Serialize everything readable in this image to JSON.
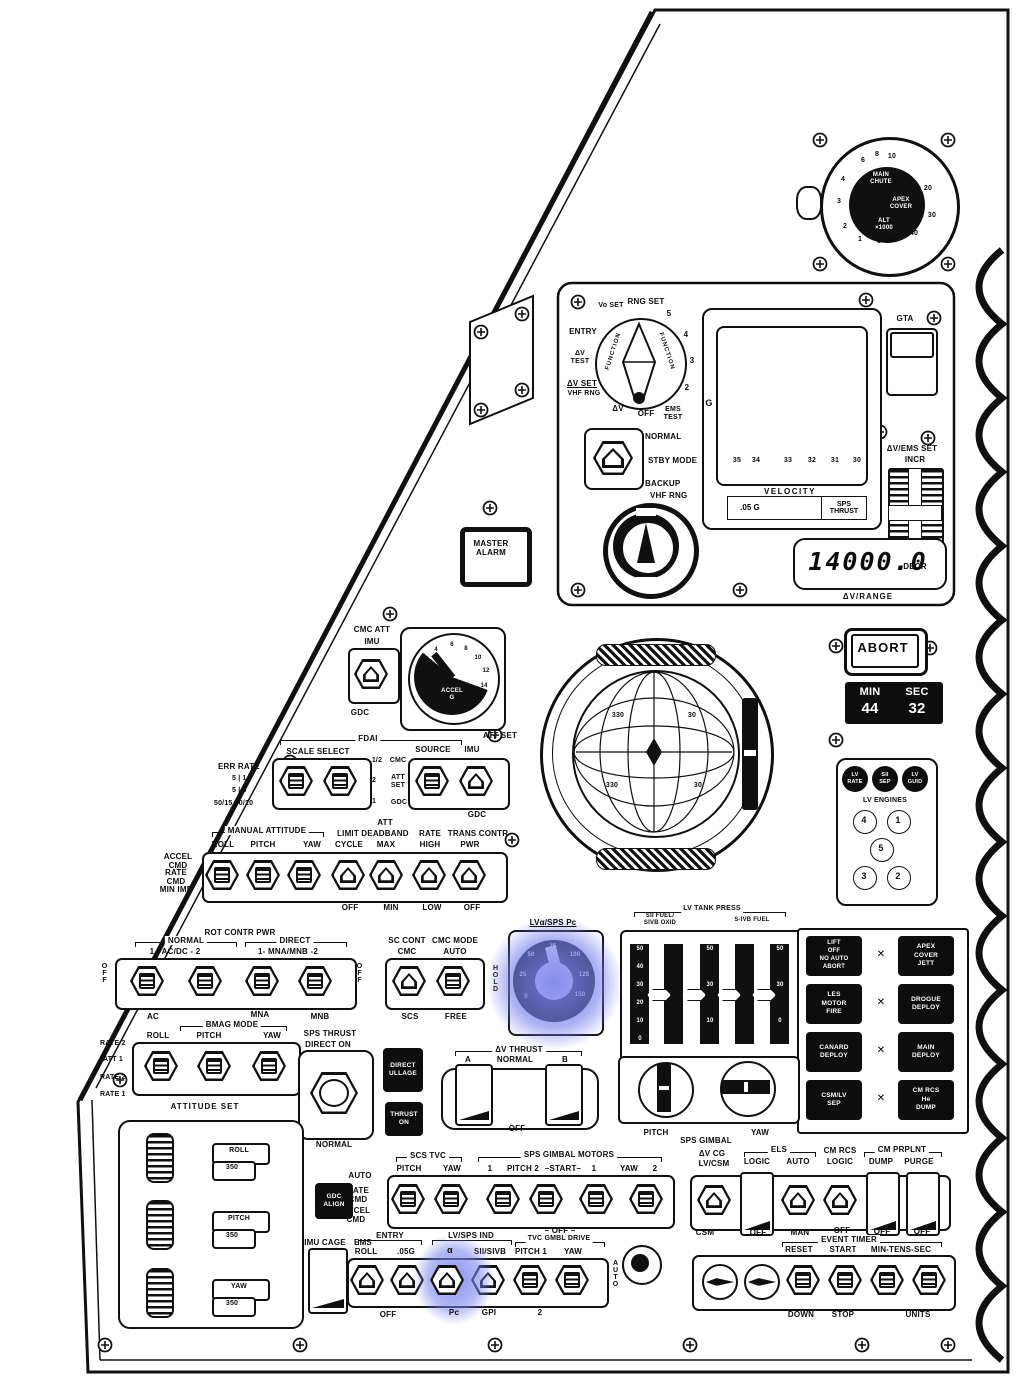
{
  "highlight_color": "#7882eb",
  "icons": {
    "xlink": "✕"
  },
  "altimeter": {
    "ticks": [
      "1",
      "2",
      "3",
      "4",
      "6",
      "8",
      "10",
      "20",
      "30",
      "40",
      "50",
      "0"
    ],
    "center": [
      "MAIN\nCHUTE",
      "APEX\nCOVER",
      "ALT\n×1000"
    ]
  },
  "ems": {
    "selector": {
      "entry": "ENTRY",
      "vo_set": "Vo SET",
      "rng_set": "RNG SET",
      "n5": "5",
      "n4": "4",
      "n3": "3",
      "n2": "2",
      "ems_test": "EMS\nTEST",
      "off": "OFF",
      "dv": "ΔV",
      "dv_set": "ΔV SET",
      "vhf_rng": "VHF RNG",
      "dv_test": "ΔV\nTEST",
      "knob": "FUNCTION"
    },
    "mode": {
      "normal": "NORMAL",
      "stby": "STBY MODE",
      "backup": "BACKUP",
      "vhf": "VHF RNG"
    },
    "gta": "GTA",
    "set": {
      "label": "ΔV/EMS SET",
      "incr": "INCR",
      "decr": "DECR"
    },
    "graph": {
      "g": "G",
      "x_ticks": [
        "35",
        "34",
        "33",
        "32",
        "31",
        "30"
      ],
      "x_label": "VELOCITY"
    },
    "lights": [
      ".05 G",
      "SPS\nTHRUST"
    ],
    "dv_display": {
      "value": "14000.0",
      "label": "ΔV/RANGE"
    }
  },
  "master_alarm": "MASTER\nALARM",
  "abort": "ABORT",
  "event_clock": {
    "min": "MIN",
    "sec": "SEC",
    "min_val": "44",
    "sec_val": "32"
  },
  "cmc_att": {
    "title": "CMC ATT",
    "imu": "IMU",
    "gdc": "GDC"
  },
  "accel": {
    "label": "ACCEL\nG",
    "ticks": [
      "0",
      "2",
      "4",
      "6",
      "8",
      "10",
      "12",
      "14",
      "16"
    ]
  },
  "fdai": {
    "ball_numbers": [
      "330",
      "30",
      "330",
      "30"
    ]
  },
  "fdai_sel": {
    "err_rate": "ERR RATE",
    "er1": "5 | 1",
    "er2": "5 | 5",
    "er3": "50/15 50/10",
    "fdai": "FDAI",
    "scale": "SCALE  SELECT",
    "mid": [
      "1/2",
      "2",
      "1"
    ],
    "src_col": [
      "CMC",
      "ATT\nSET",
      "GDC"
    ],
    "source": "SOURCE",
    "att_set": "ATT SET",
    "imu": "IMU",
    "gdc": "GDC"
  },
  "man_att": {
    "hdr": "MANUAL ATTITUDE",
    "cols": [
      "ROLL",
      "PITCH",
      "YAW"
    ],
    "left": [
      "ACCEL\nCMD",
      "RATE\nCMD",
      "MIN IMP"
    ],
    "limit": "LIMIT",
    "cycle": "CYCLE",
    "att": "ATT",
    "deadband": "DEADBAND",
    "max": "MAX",
    "rate": "RATE",
    "high": "HIGH",
    "trans": "TRANS CONTR",
    "pwr": "PWR",
    "bot": [
      "OFF",
      "MIN",
      "LOW",
      "OFF"
    ]
  },
  "lv_eng": {
    "lights": [
      "LV\nRATE",
      "SII\nSEP",
      "LV\nGUID"
    ],
    "label": "LV ENGINES",
    "nums": [
      "4",
      "1",
      "5",
      "3",
      "2"
    ]
  },
  "rot_pwr": {
    "hdr": "ROT CONTR PWR",
    "normal": "NORMAL",
    "acdc": "1 - AC/DC - 2",
    "direct": "DIRECT",
    "mnamnb": "1- MNA/MNB -2",
    "off_l": "OFF",
    "off_r": "OFF",
    "ac": "AC",
    "mna": "MNA",
    "mnb": "MNB"
  },
  "sc_cont": {
    "l1": "SC CONT",
    "l2": "CMC MODE",
    "cmc": "CMC",
    "auto": "AUTO",
    "scs": "SCS",
    "free": "FREE",
    "hold": "HOLD"
  },
  "pc_gauge": {
    "title": "LVα/SPS Pc",
    "ticks": [
      "0",
      "25",
      "50",
      "75",
      "100",
      "125",
      "150"
    ]
  },
  "tank": {
    "hdr": "LV TANK PRESS",
    "l1": "SII FUEL/\nSIVB OXID",
    "l2": "S-IVB FUEL",
    "scale": [
      "50",
      "40",
      "30",
      "20",
      "10",
      "0"
    ]
  },
  "seq": {
    "btns": [
      "LIFT\nOFF\nNO AUTO\nABORT",
      "APEX\nCOVER\nJETT",
      "LES\nMOTOR\nFIRE",
      "DROGUE\nDEPLOY",
      "CANARD\nDEPLOY",
      "MAIN\nDEPLOY",
      "CSM/LV\nSEP",
      "CM RCS\nHe\nDUMP"
    ]
  },
  "bmag": {
    "hdr": "BMAG MODE",
    "cols": [
      "ROLL",
      "PITCH",
      "YAW"
    ],
    "left": [
      "RATE 2",
      "ATT 1",
      "RATE 2",
      "RATE 1"
    ],
    "att_set": "ATTITUDE SET"
  },
  "sps_thrust": {
    "l1": "SPS THRUST",
    "l2": "DIRECT ON",
    "normal": "NORMAL"
  },
  "dark_btns": {
    "ullage": "DIRECT\nULLAGE",
    "thrust": "THRUST\nON",
    "gdc_align": "GDC\nALIGN"
  },
  "dv_thrust": {
    "hdr": "ΔV THRUST",
    "a": "A",
    "normal": "NORMAL",
    "b": "B",
    "off": "–OFF–"
  },
  "att_panel": {
    "rows": [
      {
        "name": "ROLL",
        "val": "350"
      },
      {
        "name": "PITCH",
        "val": "350"
      },
      {
        "name": "YAW",
        "val": "350"
      }
    ]
  },
  "gimbal": {
    "pitch": "PITCH",
    "yaw": "YAW",
    "label": "SPS GIMBAL"
  },
  "tvc": {
    "hdr": "SCS TVC",
    "pitch": "PITCH",
    "yaw": "YAW",
    "left": [
      "AUTO",
      "RATE\nCMD",
      "ACCEL\nCMD"
    ],
    "motors_hdr": "SPS GIMBAL MOTORS",
    "motors": [
      "1",
      "PITCH 2",
      "–START–",
      "1",
      "YAW",
      "2"
    ],
    "off": "– OFF –"
  },
  "entry_row": {
    "imu_cage": "IMU CAGE",
    "entry": "ENTRY",
    "ems": "EMS",
    "roll": "ROLL",
    "g05": ".05G",
    "off": "OFF",
    "lvsps": "LV/SPS IND",
    "alpha": "α",
    "pc": "Pc",
    "sii": "SII/SIVB",
    "gpi": "GPI",
    "tvc_hdr": "TVC GMBL DRIVE",
    "pitch": "PITCH 1",
    "yaw": "YAW",
    "two": "2",
    "auto": "AUTO"
  },
  "els_row": {
    "dvcg1": "ΔV CG",
    "dvcg2": "LV/CSM",
    "csm": "CSM",
    "els": "ELS",
    "logic": "LOGIC",
    "auto": "AUTO",
    "off1": "OFF",
    "man": "MAN",
    "cmrcs1": "CM RCS",
    "cmrcs2": "LOGIC",
    "off2": "OFF",
    "prplnt": "CM PRPLNT",
    "dump": "DUMP",
    "purge": "PURGE",
    "off3": "OFF",
    "off4": "OFF"
  },
  "event_timer": {
    "hdr": "EVENT TIMER",
    "reset": "RESET",
    "start": "START",
    "mts": "MIN-TENS-SEC",
    "down": "DOWN",
    "stop": "STOP",
    "units": "UNITS"
  }
}
